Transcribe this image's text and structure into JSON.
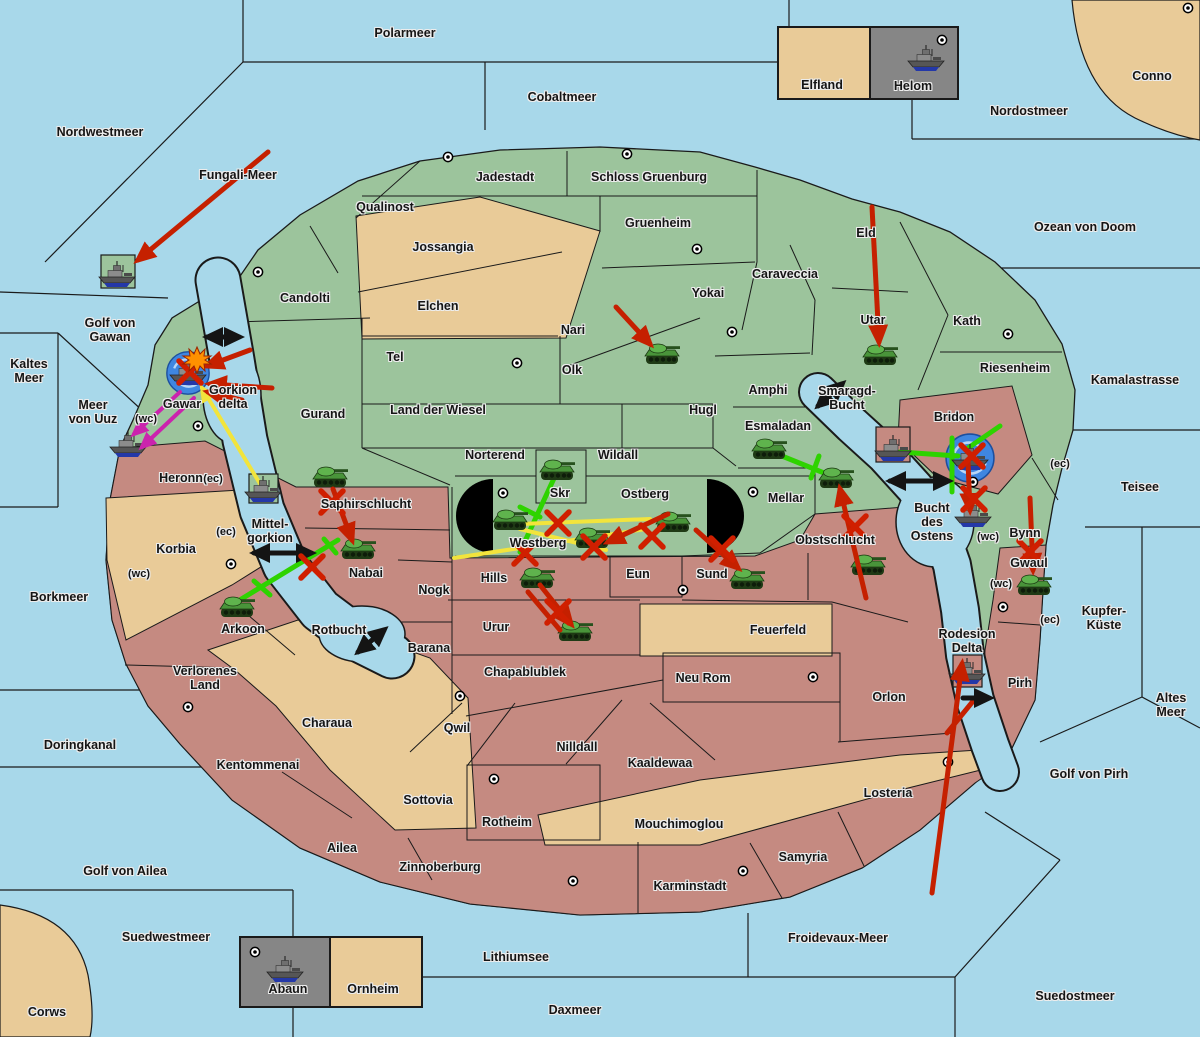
{
  "labels": {
    "polarmeer": "Polarmeer",
    "cobaltmeer": "Cobaltmeer",
    "nordostmeer": "Nordostmeer",
    "nordwestmeer": "Nordwestmeer",
    "fungali_meer": "Fungali-Meer",
    "ozean_von_doom": "Ozean von Doom",
    "kaltes_meer": "Kaltes\nMeer",
    "golf_von_gawan": "Golf von\nGawan",
    "meer_von_uuz": "Meer\nvon Uuz",
    "kamalastrasse": "Kamalastrasse",
    "teisee": "Teisee",
    "borkmeer": "Borkmeer",
    "kupfer_kueste": "Kupfer-\nKüste",
    "doringkanal": "Doringkanal",
    "altes_meer": "Altes\nMeer",
    "golf_von_pirh": "Golf von Pirh",
    "golf_von_ailea": "Golf von Ailea",
    "suedwestmeer": "Suedwestmeer",
    "froidevaux_meer": "Froidevaux-Meer",
    "lithiumsee": "Lithiumsee",
    "daxmeer": "Daxmeer",
    "suedostmeer": "Suedostmeer",
    "corws": "Corws",
    "conno": "Conno",
    "gorkion_delta": "Gorkion\ndelta",
    "mittelgorkion": "Mittel-\ngorkion",
    "rotbucht": "Rotbucht",
    "smaragd_bucht": "Smaragd-\nBucht",
    "bucht_des_ostens": "Bucht\ndes\nOstens",
    "rodesion_delta": "Rodesion\nDelta",
    "jadestadt": "Jadestadt",
    "schloss_gruenburg": "Schloss Gruenburg",
    "qualinost": "Qualinost",
    "jossangia": "Jossangia",
    "elchen": "Elchen",
    "gruenheim": "Gruenheim",
    "caraveccia": "Caraveccia",
    "yokai": "Yokai",
    "candolti": "Candolti",
    "nari": "Nari",
    "olk": "Olk",
    "tel": "Tel",
    "gurand": "Gurand",
    "land_der_wiesel": "Land der Wiesel",
    "hugl": "Hugl",
    "amphi": "Amphi",
    "norterend": "Norterend",
    "wildall": "Wildall",
    "skr": "Skr",
    "ostberg": "Ostberg",
    "esmaladan": "Esmaladan",
    "mellar": "Mellar",
    "eld": "Eld",
    "utar": "Utar",
    "kath": "Kath",
    "riesenheim": "Riesenheim",
    "gawar": "Gawar",
    "bynn": "Bynn",
    "westberg": "Westberg",
    "bridon": "Bridon",
    "heronn": "Heronn",
    "korbia": "Korbia",
    "verlorenes_land": "Verlorenes\nLand",
    "arkoon": "Arkoon",
    "saphirschlucht": "Saphirschlucht",
    "nabai": "Nabai",
    "nogk": "Nogk",
    "barana": "Barana",
    "hills": "Hills",
    "urur": "Urur",
    "eun": "Eun",
    "sund": "Sund",
    "obstschlucht": "Obstschlucht",
    "feuerfeld": "Feuerfeld",
    "neu_rom": "Neu Rom",
    "chapablublek": "Chapablublek",
    "qwil": "Qwil",
    "nilldall": "Nilldall",
    "kaaldewaa": "Kaaldewaa",
    "charaua": "Charaua",
    "kentommenai": "Kentommenai",
    "sottovia": "Sottovia",
    "ailea": "Ailea",
    "zinnoberburg": "Zinnoberburg",
    "rotheim": "Rotheim",
    "mouchimoglou": "Mouchimoglou",
    "karminstadt": "Karminstadt",
    "samyria": "Samyria",
    "losteria": "Losteria",
    "orlon": "Orlon",
    "pirh": "Pirh",
    "gwaul": "Gwaul",
    "elfland": "Elfland",
    "helom": "Helom",
    "abaun": "Abaun",
    "ornheim": "Ornheim",
    "wc": "(wc)",
    "ec": "(ec)"
  },
  "icons": {
    "tank": "tank-icon",
    "warship": "warship-icon",
    "supply_center": "supply-center-icon",
    "whirlpool": "whirlpool-icon",
    "explosion": "explosion-icon",
    "attack": "attack-arrow",
    "support": "support-line",
    "convoy": "convoy-line",
    "retreat": "retreat-arrow",
    "water_route": "water-route-arrow",
    "failed": "failed-order-x"
  },
  "colors": {
    "sea": "#a8d8ea",
    "land_north": "#9cc49c",
    "land_south": "#c58a81",
    "land_neutral": "#e9cb98",
    "inset_gray": "#868686",
    "attack_red": "#c52000",
    "support_green": "#2ed300",
    "convoy_yellow": "#f2e43c",
    "retreat_magenta": "#cb23ad",
    "route_black": "#141414",
    "whirlpool_blue": "#3f86e0"
  }
}
